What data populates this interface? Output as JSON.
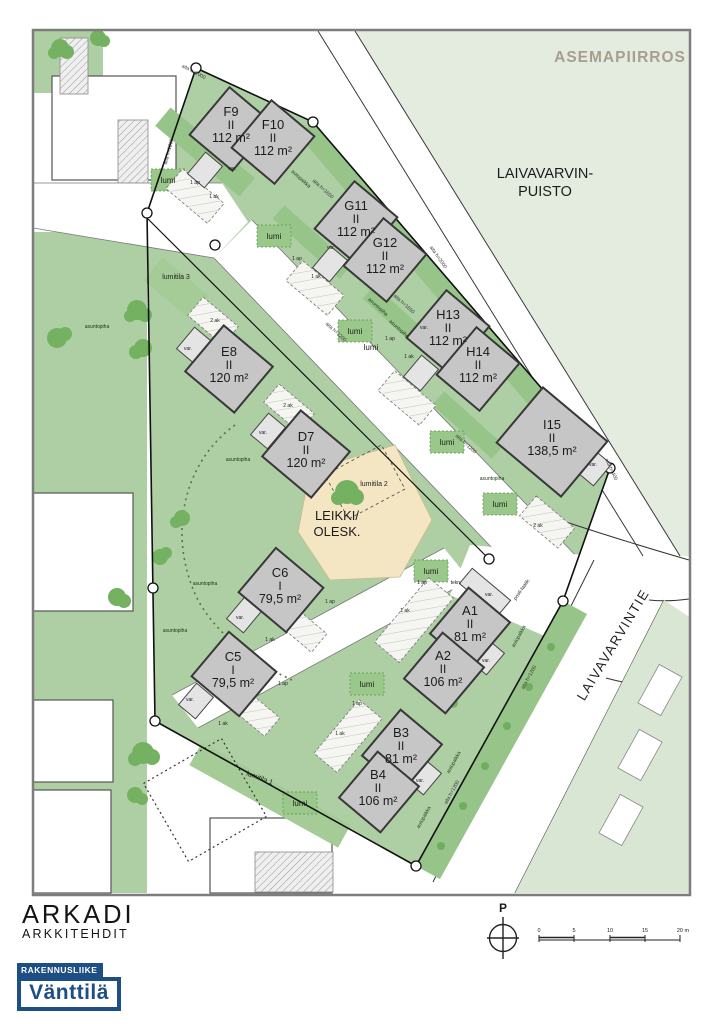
{
  "page": {
    "title": "ASEMAPIIRROS"
  },
  "map": {
    "park": {
      "line1": "LAIVAVARVIN-",
      "line2": "PUISTO"
    },
    "street": "LAIVAVARVINTIE",
    "play_area": {
      "line1": "LEIKKI/",
      "line2": "OLESK."
    },
    "buildings": [
      {
        "id": "F9",
        "storeys": "II",
        "area": "112 m²"
      },
      {
        "id": "F10",
        "storeys": "II",
        "area": "112 m²"
      },
      {
        "id": "G11",
        "storeys": "II",
        "area": "112 m²"
      },
      {
        "id": "G12",
        "storeys": "II",
        "area": "112 m²"
      },
      {
        "id": "H13",
        "storeys": "II",
        "area": "112 m²"
      },
      {
        "id": "H14",
        "storeys": "II",
        "area": "112 m²"
      },
      {
        "id": "I15",
        "storeys": "II",
        "area": "138,5 m²"
      },
      {
        "id": "E8",
        "storeys": "II",
        "area": "120 m²"
      },
      {
        "id": "D7",
        "storeys": "II",
        "area": "120 m²"
      },
      {
        "id": "C6",
        "storeys": "I",
        "area": "79,5 m²"
      },
      {
        "id": "C5",
        "storeys": "I",
        "area": "79,5 m²"
      },
      {
        "id": "A1",
        "storeys": "II",
        "area": "81 m²"
      },
      {
        "id": "A2",
        "storeys": "II",
        "area": "106 m²"
      },
      {
        "id": "B3",
        "storeys": "II",
        "area": "81 m²"
      },
      {
        "id": "B4",
        "storeys": "II",
        "area": "106 m²"
      }
    ],
    "labels": {
      "snow_area_1": "lumitila 1",
      "snow_area_2": "lumitila 2",
      "snow_area_3": "lumitila 3",
      "snow": "lumi",
      "yard": "asuntopiha",
      "parking": "autopaikka",
      "fence_1200": "aita h=1200",
      "fence_1650": "aita h=1650",
      "fence_2000": "aita h=2000",
      "fence_400": "aita h=400",
      "parking_space": "1 ap",
      "carport_1": "1 ak",
      "carport_2": "2 ak",
      "storage": "var.",
      "technical": "tekn.",
      "mailboxes": "posti-laatik."
    }
  },
  "footer": {
    "architect": {
      "line1": "ARKADI",
      "line2": "ARKKITEHDIT"
    },
    "builder": {
      "banner": "RAKENNUSLIIKE",
      "name": "Vänttilä"
    },
    "compass": {
      "north": "P"
    },
    "scale_bar": {
      "ticks": [
        "0",
        "5",
        "10",
        "15",
        "20 m"
      ]
    }
  },
  "colors": {
    "park_green": "#e4ecdf",
    "site_green": "#aecfa4",
    "strip_green": "#96c489",
    "tree_green": "#74b161",
    "edge_green": "#d9e6d3",
    "building_gray": "#c6c6c6",
    "aux_gray": "#e4e4e4",
    "play_tan": "#f4e6c2",
    "logo_blue": "#1d4e84",
    "title_gray": "#a69e8e"
  }
}
